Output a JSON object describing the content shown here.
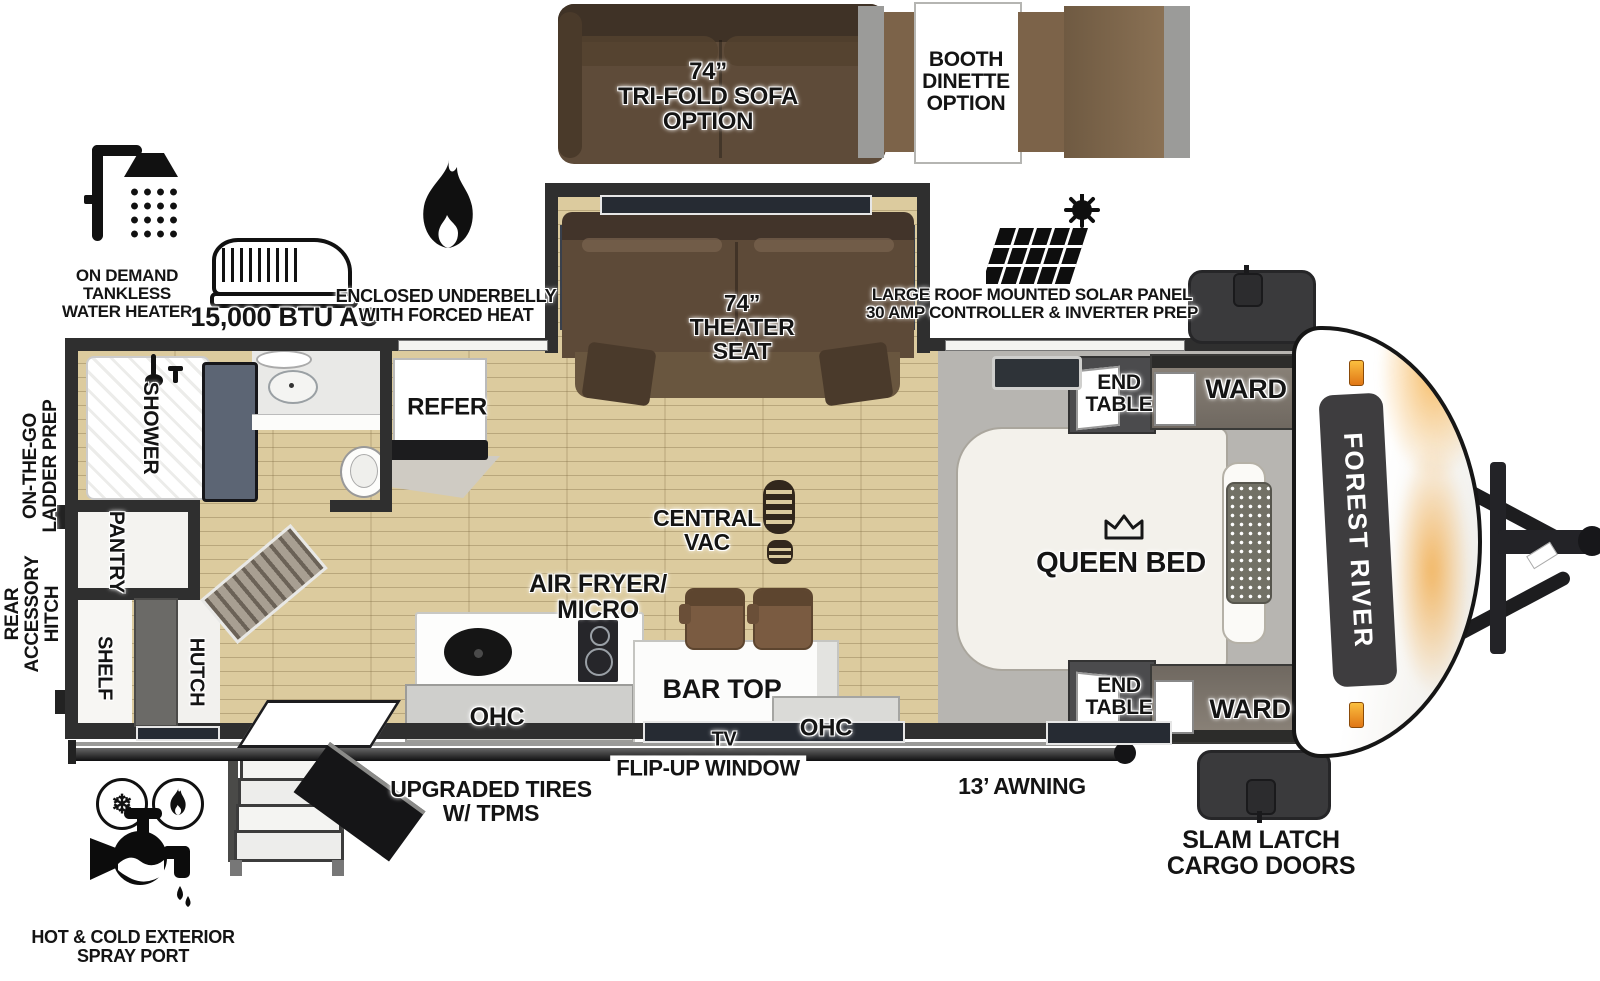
{
  "colors": {
    "wall": "#2f2f2f",
    "wood": "#dccb9e",
    "carpet": "#b7b5b1",
    "sofa-brown": "#5e4b39",
    "sofa-dark": "#42342a",
    "bench-brown": "#7c6349",
    "slate": "#5c6574",
    "accent-orange": "#f59b2e",
    "badge-dark": "#3e3d3f"
  },
  "options": {
    "trifold_sofa_label": "74”\nTRI-FOLD SOFA\nOPTION",
    "booth_dinette_label": "BOOTH\nDINETTE\nOPTION"
  },
  "callouts": {
    "water_heater": "ON DEMAND\nTANKLESS\nWATER HEATER",
    "ac": "15,000 BTU AC",
    "underbelly": "ENCLOSED UNDERBELLY\nWITH FORCED HEAT",
    "solar": "LARGE ROOF MOUNTED SOLAR PANEL\n30 AMP CONTROLLER & INVERTER PREP",
    "ladder_prep": "ON-THE-GO\nLADDER PREP",
    "rear_hitch": "REAR\nACCESSORY\nHITCH",
    "spray_port": "HOT & COLD EXTERIOR\nSPRAY PORT",
    "tires": "UPGRADED TIRES\nW/ TPMS",
    "flip_up_window": "FLIP-UP WINDOW",
    "awning": "13’ AWNING",
    "cargo_doors": "SLAM LATCH\nCARGO DOORS"
  },
  "rooms": {
    "theater_seat": "74”\nTHEATER\nSEAT",
    "shower": "SHOWER",
    "pantry": "PANTRY",
    "shelf": "SHELF",
    "hutch": "HUTCH",
    "refer": "REFER",
    "central_vac": "CENTRAL\nVAC",
    "air_fryer_micro": "AIR FRYER/\nMICRO",
    "ohc_left": "OHC",
    "bar_top": "BAR TOP",
    "tv": "TV",
    "ohc_right": "OHC",
    "queen_bed": "QUEEN BED",
    "end_table_top": "END\nTABLE",
    "ward_top": "WARD",
    "end_table_bottom": "END\nTABLE",
    "ward_bottom": "WARD"
  },
  "branding": {
    "manufacturer": "FOREST RIVER"
  },
  "icons": {
    "snowflake_glyph": "❄"
  }
}
